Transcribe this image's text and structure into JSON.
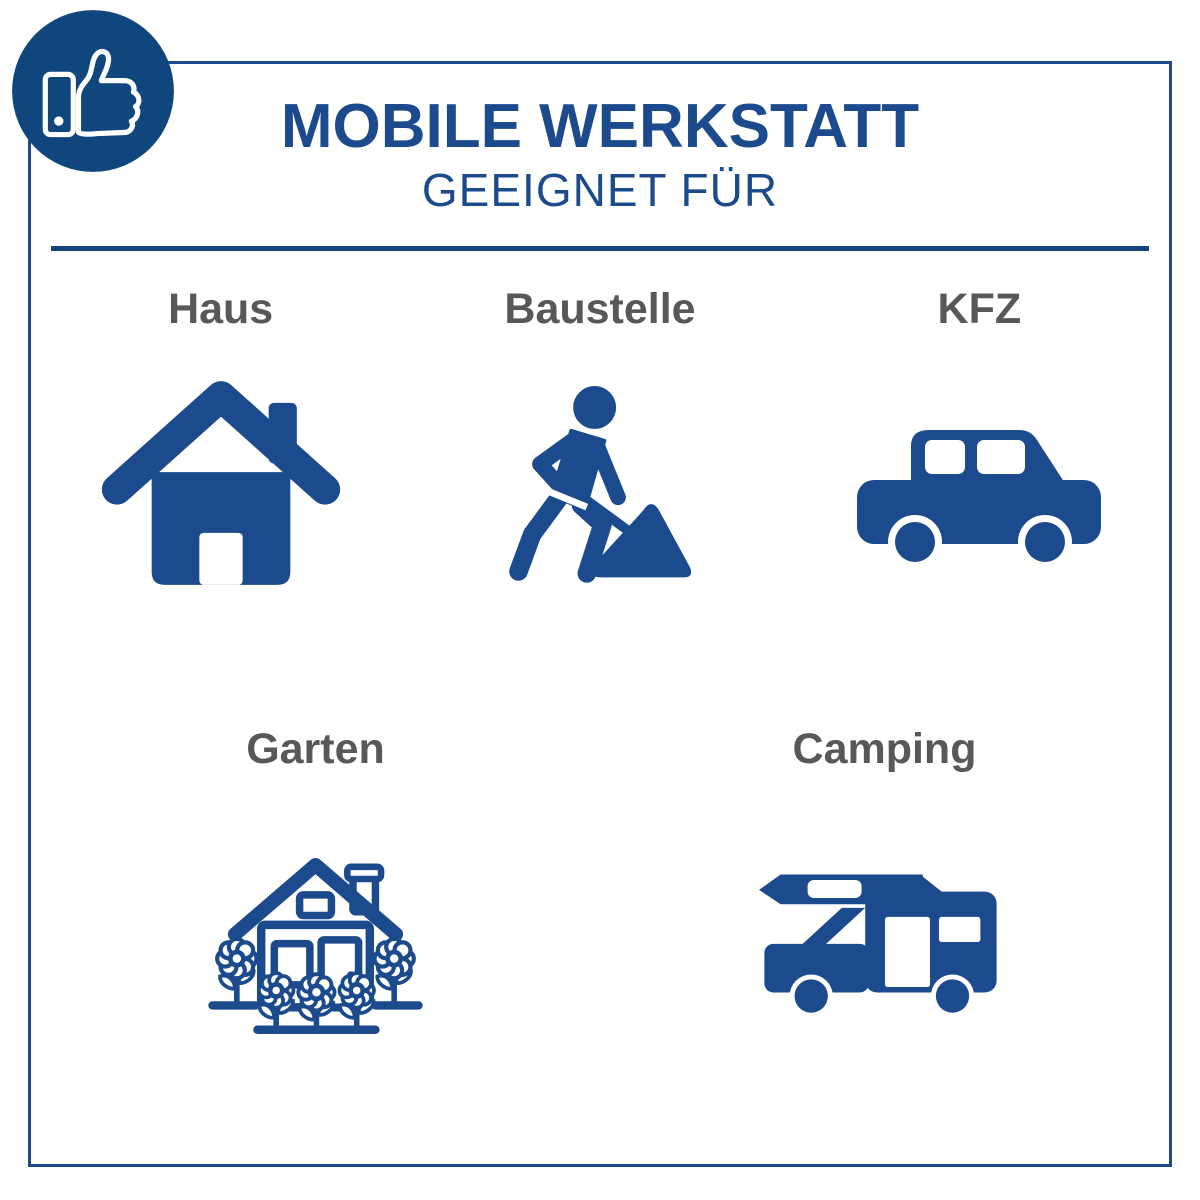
{
  "badge": {
    "icon": "thumbs-up-icon"
  },
  "header": {
    "title": "MOBILE WERKSTATT",
    "subtitle": "GEEIGNET FÜR"
  },
  "rows": [
    {
      "items": [
        {
          "label": "Haus",
          "icon": "house-icon"
        },
        {
          "label": "Baustelle",
          "icon": "construction-worker-icon"
        },
        {
          "label": "KFZ",
          "icon": "car-icon"
        }
      ]
    },
    {
      "items": [
        {
          "label": "Garten",
          "icon": "garden-house-icon"
        },
        {
          "label": "Camping",
          "icon": "camper-van-icon"
        }
      ]
    }
  ],
  "colors": {
    "primary_blue": "#1b4b8c",
    "badge_blue": "#10467e",
    "divider_blue": "#17457f",
    "label_gray": "#58585a",
    "background": "#ffffff"
  }
}
